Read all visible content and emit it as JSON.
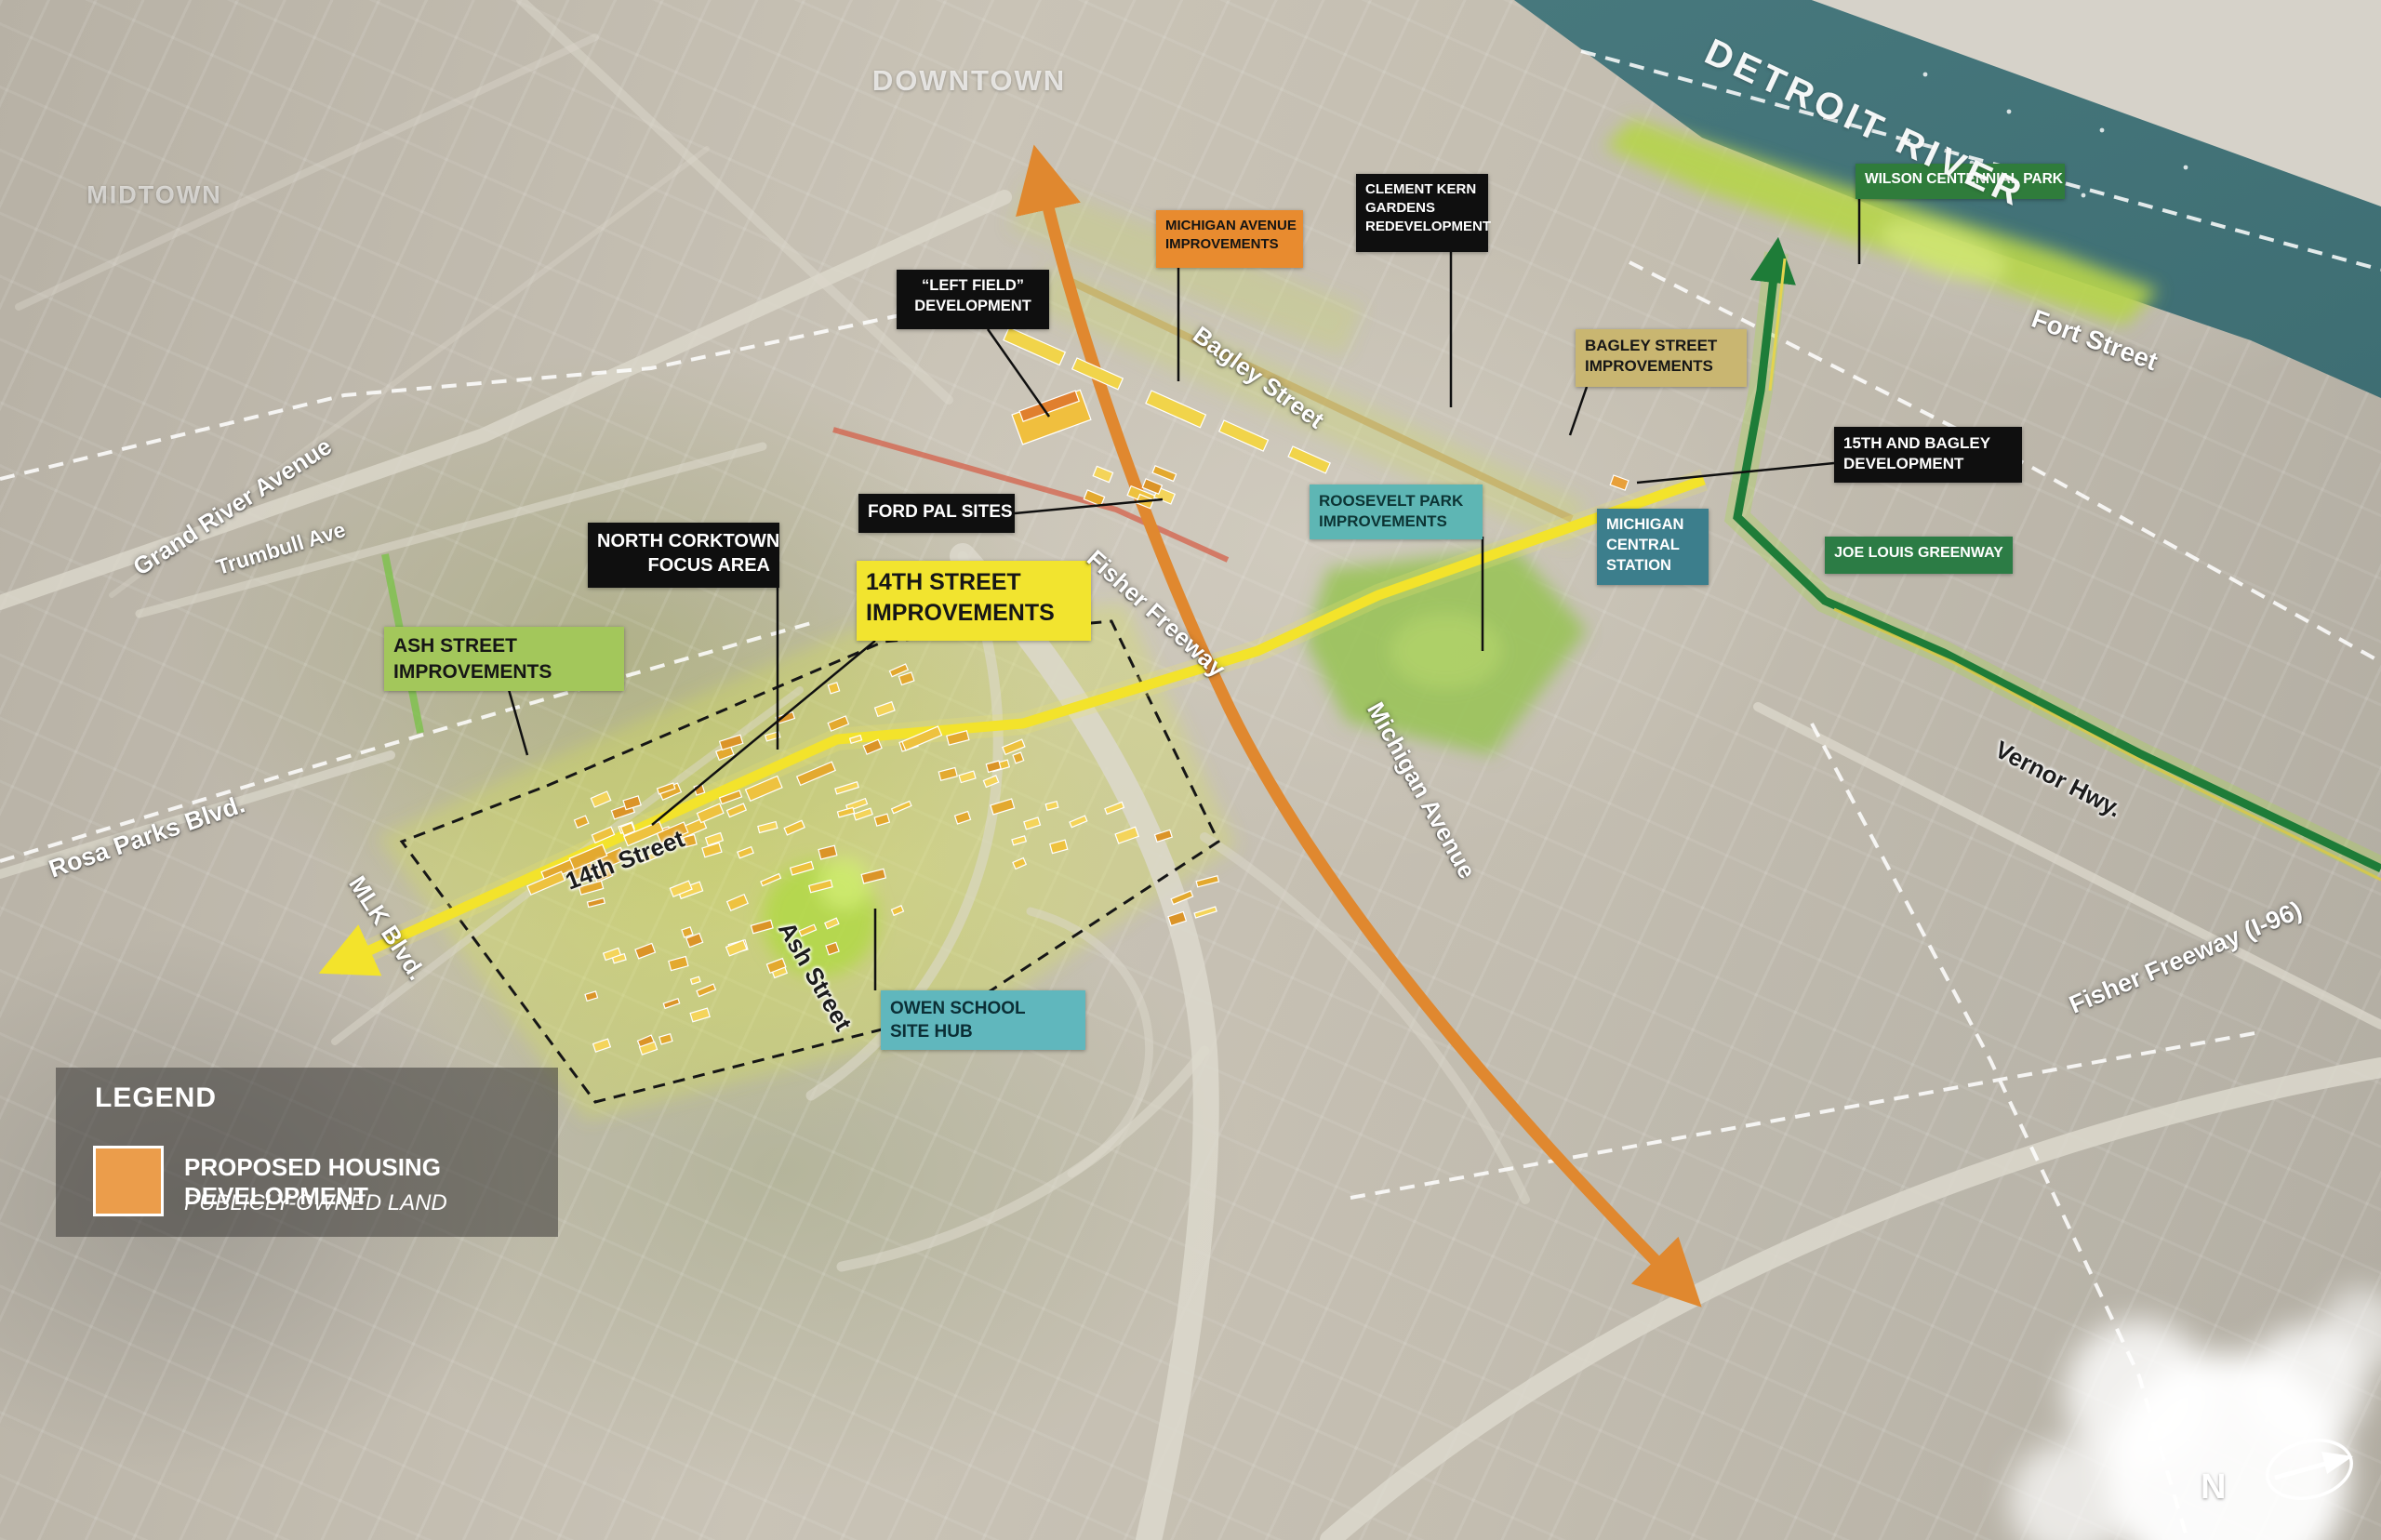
{
  "map": {
    "area_labels": [
      {
        "id": "midtown",
        "text": "MIDTOWN"
      },
      {
        "id": "downtown",
        "text": "DOWNTOWN"
      },
      {
        "id": "detroit-river",
        "text": "DETROIT RIVER"
      }
    ],
    "street_labels": [
      {
        "id": "grand-river-avenue",
        "text": "Grand River Avenue"
      },
      {
        "id": "trumbull-ave",
        "text": "Trumbull Ave"
      },
      {
        "id": "rosa-parks-blvd",
        "text": "Rosa Parks Blvd."
      },
      {
        "id": "mlk-blvd",
        "text": "MLK Blvd."
      },
      {
        "id": "fourteenth-street",
        "text": "14th Street"
      },
      {
        "id": "ash-street",
        "text": "Ash Street"
      },
      {
        "id": "fisher-freeway",
        "text": "Fisher Freeway"
      },
      {
        "id": "michigan-avenue",
        "text": "Michigan Avenue"
      },
      {
        "id": "bagley-street",
        "text": "Bagley Street"
      },
      {
        "id": "fort-street",
        "text": "Fort Street"
      },
      {
        "id": "vernor-hwy",
        "text": "Vernor Hwy."
      },
      {
        "id": "fisher-freeway-i96",
        "text": "Fisher Freeway (I-96)"
      }
    ],
    "callouts": [
      {
        "id": "wilson-centennial-park",
        "lines": [
          "WILSON CENTENNIAL PARK"
        ],
        "bg": "#2f7c3b",
        "color": "#ffffff"
      },
      {
        "id": "clement-kern-gardens",
        "lines": [
          "CLEMENT KERN",
          "GARDENS",
          "REDEVELOPMENT"
        ],
        "bg": "#0f0f0f",
        "color": "#ffffff"
      },
      {
        "id": "michigan-avenue-improvements",
        "lines": [
          "MICHIGAN AVENUE",
          "IMPROVEMENTS"
        ],
        "bg": "#e88b2f",
        "color": "#141414"
      },
      {
        "id": "left-field-development",
        "lines": [
          "“LEFT FIELD”",
          "DEVELOPMENT"
        ],
        "bg": "#0f0f0f",
        "color": "#ffffff"
      },
      {
        "id": "bagley-street-improvements",
        "lines": [
          "BAGLEY STREET",
          "IMPROVEMENTS"
        ],
        "bg": "#c9b671",
        "color": "#161616"
      },
      {
        "id": "fifteenth-and-bagley-development",
        "lines": [
          "15TH AND BAGLEY",
          "DEVELOPMENT"
        ],
        "bg": "#0f0f0f",
        "color": "#ffffff"
      },
      {
        "id": "roosevelt-park-improvements",
        "lines": [
          "ROOSEVELT PARK",
          "IMPROVEMENTS"
        ],
        "bg": "#5eb6b4",
        "color": "#0c3434"
      },
      {
        "id": "michigan-central-station",
        "lines": [
          "MICHIGAN",
          "CENTRAL",
          "STATION"
        ],
        "bg": "#3c7e8c",
        "color": "#ffffff"
      },
      {
        "id": "joe-louis-greenway",
        "lines": [
          "JOE LOUIS GREENWAY"
        ],
        "bg": "#2c7c45",
        "color": "#ffffff"
      },
      {
        "id": "ford-pal-sites",
        "lines": [
          "FORD PAL SITES"
        ],
        "bg": "#0f0f0f",
        "color": "#ffffff"
      },
      {
        "id": "north-corktown-focus-area",
        "lines": [
          "NORTH CORKTOWN",
          "FOCUS AREA"
        ],
        "bg": "#0f0f0f",
        "color": "#ffffff"
      },
      {
        "id": "fourteenth-street-improvements",
        "lines": [
          "14TH STREET",
          "IMPROVEMENTS"
        ],
        "bg": "#f2e42f",
        "color": "#161616"
      },
      {
        "id": "ash-street-improvements",
        "lines": [
          "ASH STREET",
          "IMPROVEMENTS"
        ],
        "bg": "#a3c75b",
        "color": "#161616"
      },
      {
        "id": "owen-school-site-hub",
        "lines": [
          "OWEN SCHOOL",
          "SITE HUB"
        ],
        "bg": "#60b7bd",
        "color": "#0b2f36"
      }
    ],
    "legend": {
      "title": "LEGEND",
      "item": {
        "title": "PROPOSED HOUSING DEVELOPMENT",
        "subtitle": "PUBLICLY-OWNED LAND"
      },
      "swatch_color": "#eb9d4b"
    },
    "north_label": "N",
    "colors": {
      "water": "#47787d",
      "water_deep": "#3e6e73",
      "far_shore": "#d6d2c9",
      "park_green": "#b6d44c",
      "michigan_avenue_line": "#e0882f",
      "corridor_line": "#f3e32b",
      "greenway_line": "#1e7c38",
      "bagley_line": "#c6b26b",
      "rail_line": "#d4604a",
      "ash_line": "#7cc24a",
      "housing_palette": [
        "#eec23f",
        "#e3a92f",
        "#f4d45a",
        "#db9428"
      ],
      "dashed_white": "#ffffff",
      "dashed_black": "#161616"
    }
  }
}
